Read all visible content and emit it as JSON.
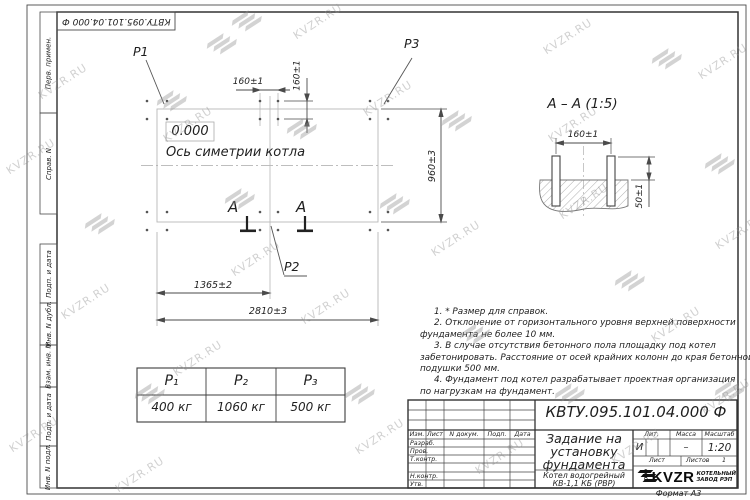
{
  "watermark": {
    "text": "KVZR.RU"
  },
  "corner_stamp": {
    "designation": "КВТУ.095.101.04.000  Ф"
  },
  "side_column": {
    "items": [
      "Перв. примен.",
      "Справ. N",
      "Подп. и дата",
      "Инв. N дубл.",
      "Взам. инв. N",
      "Подп. и дата",
      "Инв. N подл."
    ]
  },
  "plan": {
    "p1": "P1",
    "p2": "P2",
    "p3": "P3",
    "zero_mark": "0.000",
    "axis_label": "Ось симетрии котла",
    "section_letter": "А",
    "dim_bolt_h": "160±1",
    "dim_bolt_v": "160±1",
    "dim_width": "960±3",
    "dim_p2": "1365±2",
    "dim_length": "2810±3"
  },
  "section_view": {
    "title": "А – А (1:5)",
    "dim_spacing": "160±1",
    "dim_height": "50±1"
  },
  "notes": {
    "lines": [
      "1. * Размер для справок.",
      "2. Отклонение от горизонтального уровня верхней поверхности",
      "фундамента не более 10 мм.",
      "3. В случае отсутствия бетонного пола площадку под котел",
      "забетонировать. Расстояние от осей крайних колонн до края бетонной",
      "подушки 500 мм.",
      "4. Фундамент под котел разрабатывает проектная организация",
      "по нагрузкам на фундамент."
    ]
  },
  "load_table": {
    "headers": [
      "P₁",
      "P₂",
      "P₃"
    ],
    "values": [
      "400 кг",
      "1060 кг",
      "500 кг"
    ]
  },
  "title_block": {
    "designation": "КВТУ.095.101.04.000  Ф",
    "doc_title_lines": [
      "Задание на",
      "установку",
      "фундамента"
    ],
    "product_lines": [
      "Котел водогрейный",
      "КВ-1,1 КБ (РВР)"
    ],
    "columns": [
      "Изм.",
      "Лист",
      "N докум.",
      "Подп.",
      "Дата"
    ],
    "rows": [
      "Разраб.",
      "Пров.",
      "Т.контр.",
      "Н.контр.",
      "Утв."
    ],
    "lit_label": "Лит.",
    "lit_value": "И",
    "mass_label": "Масса",
    "mass_value": "–",
    "scale_label": "Масштаб",
    "scale_value": "1:20",
    "sheet_label": "Лист",
    "sheets_label": "Листов",
    "sheets_value": "1",
    "logo": {
      "ooo": "ООО",
      "name": "KVZR",
      "sub1": "КОТЕЛЬНЫЙ",
      "sub2": "ЗАВОД РЭП"
    },
    "format_label": "Формат А3"
  }
}
